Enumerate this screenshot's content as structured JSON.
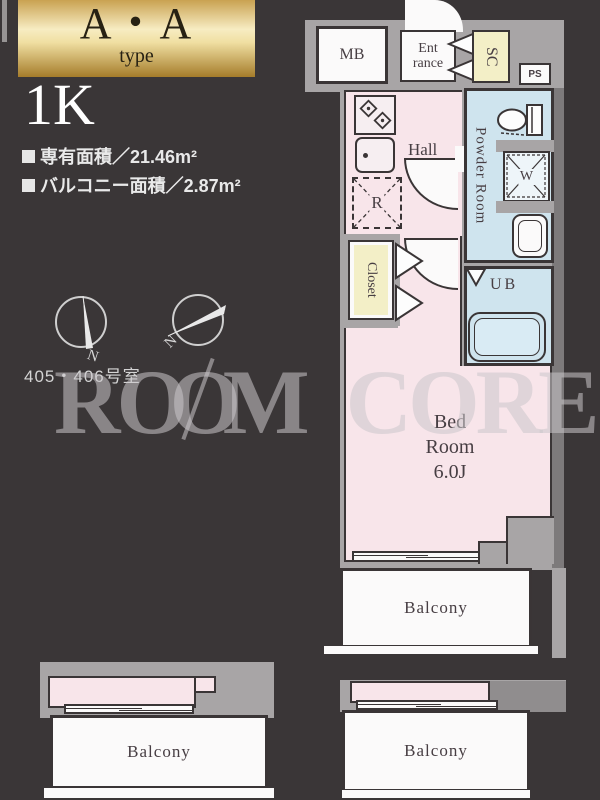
{
  "header": {
    "type_name": "A・A",
    "type_word": "type",
    "layout_type": "1K",
    "exclusive_area": "専有面積／21.46m²",
    "balcony_area": "バルコニー面積／2.87m²",
    "room_numbers": "405・406号室"
  },
  "watermark": {
    "part_r": "R",
    "part_oo": "OO",
    "part_m": "M",
    "word2": "CORE"
  },
  "plan": {
    "mb": "MB",
    "entrance_line1": "Ent",
    "entrance_line2": "rance",
    "shoe_closet": "SC",
    "pipe_space": "PS",
    "hall": "Hall",
    "powder_room": "Powder Room",
    "washer": "W",
    "refrigerator": "R",
    "closet": "Closet",
    "unit_bath": "UB",
    "bedroom_line1": "Bed",
    "bedroom_line2": "Room",
    "bedroom_size": "6.0J",
    "balcony_main": "Balcony",
    "balcony_bottom_left": "Balcony",
    "balcony_bottom_right": "Balcony",
    "compass1_north": "N",
    "compass2_north": "N"
  },
  "theme": {
    "bg": "#3a3637",
    "planGray": "#a8a5a6",
    "planGrayDark": "#7d7a7b",
    "pink": "#f8e5ea",
    "blue": "#cfe4ee",
    "yellow": "#f3efc7",
    "gold1": "#c9a251",
    "gold2": "#f7ecc2",
    "gold3": "#a57c2a",
    "line": "#3a3536",
    "textDark": "#473e43"
  }
}
